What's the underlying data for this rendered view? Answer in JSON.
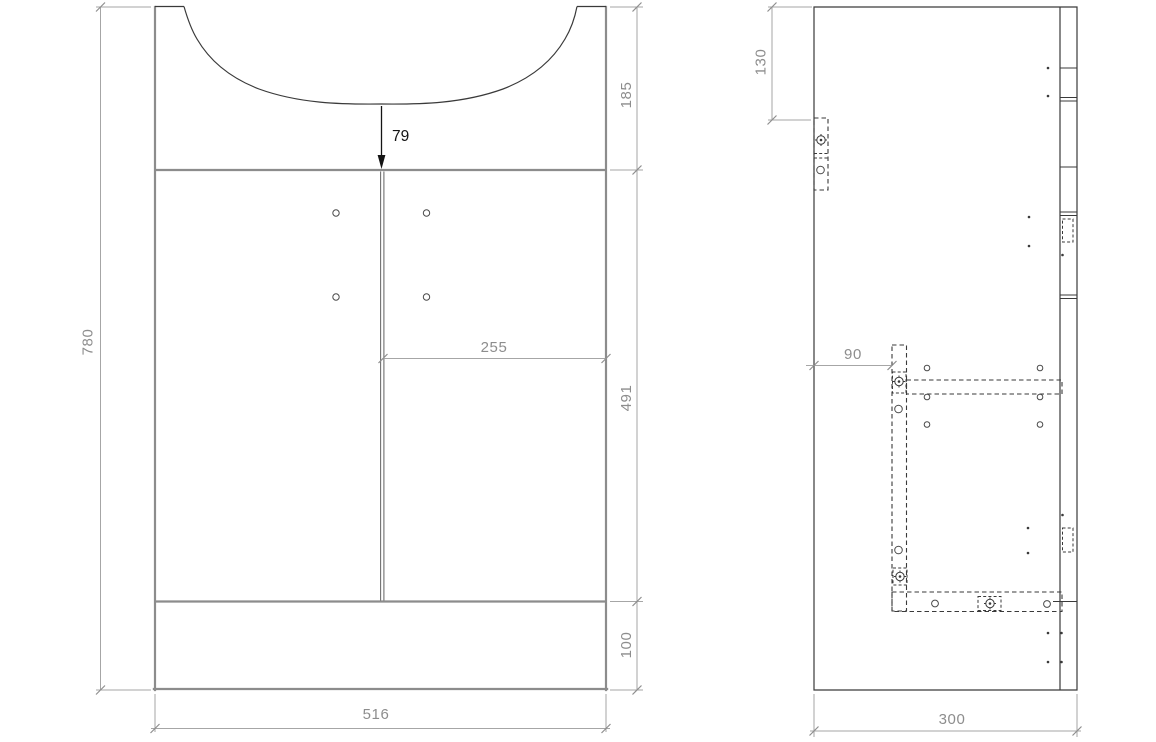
{
  "front_view": {
    "dims": {
      "total_height": "780",
      "top_section_height": "185",
      "basin_recess_depth": "79",
      "door_width": "255",
      "door_section_height": "491",
      "plinth_height": "100",
      "total_width": "516"
    }
  },
  "side_view": {
    "dims": {
      "top_hinge_offset": "130",
      "runner_offset": "90",
      "total_depth": "300"
    }
  },
  "colors": {
    "background": "#ffffff",
    "outline": "#3a3a3a",
    "frame_gray": "#8c8c8c",
    "dimension_line": "#a6a6a6",
    "dimension_text": "#8d8d8d",
    "annotation_text": "#141414"
  }
}
